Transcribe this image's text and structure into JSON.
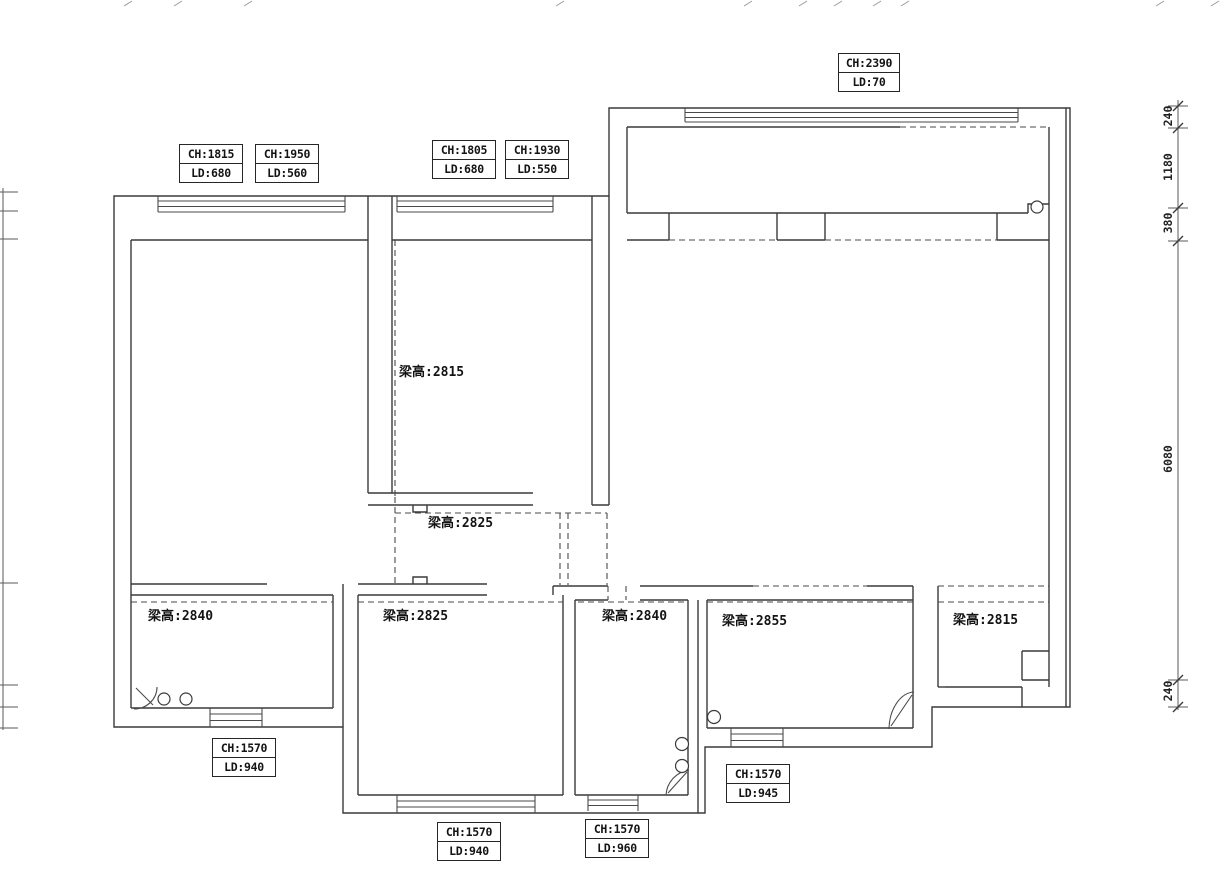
{
  "drawing": {
    "type": "residential floor plan - beam heights and window sizes survey",
    "background_color": "#ffffff",
    "line_color": "#3a3a3a"
  },
  "labels_top": [
    {
      "ch": "CH:1815",
      "ld": "LD:680"
    },
    {
      "ch": "CH:1950",
      "ld": "LD:560"
    },
    {
      "ch": "CH:1805",
      "ld": "LD:680"
    },
    {
      "ch": "CH:1930",
      "ld": "LD:550"
    },
    {
      "ch": "CH:2390",
      "ld": "LD:70"
    }
  ],
  "labels_bottom": [
    {
      "ch": "CH:1570",
      "ld": "LD:940"
    },
    {
      "ch": "CH:1570",
      "ld": "LD:940"
    },
    {
      "ch": "CH:1570",
      "ld": "LD:960"
    },
    {
      "ch": "CH:1570",
      "ld": "LD:945"
    }
  ],
  "beam_labels": [
    "梁高:2815",
    "梁高:2825",
    "梁高:2840",
    "梁高:2825",
    "梁高:2840",
    "梁高:2855",
    "梁高:2815"
  ],
  "right_dimensions": [
    "240",
    "1180",
    "380",
    "6080",
    "240"
  ]
}
